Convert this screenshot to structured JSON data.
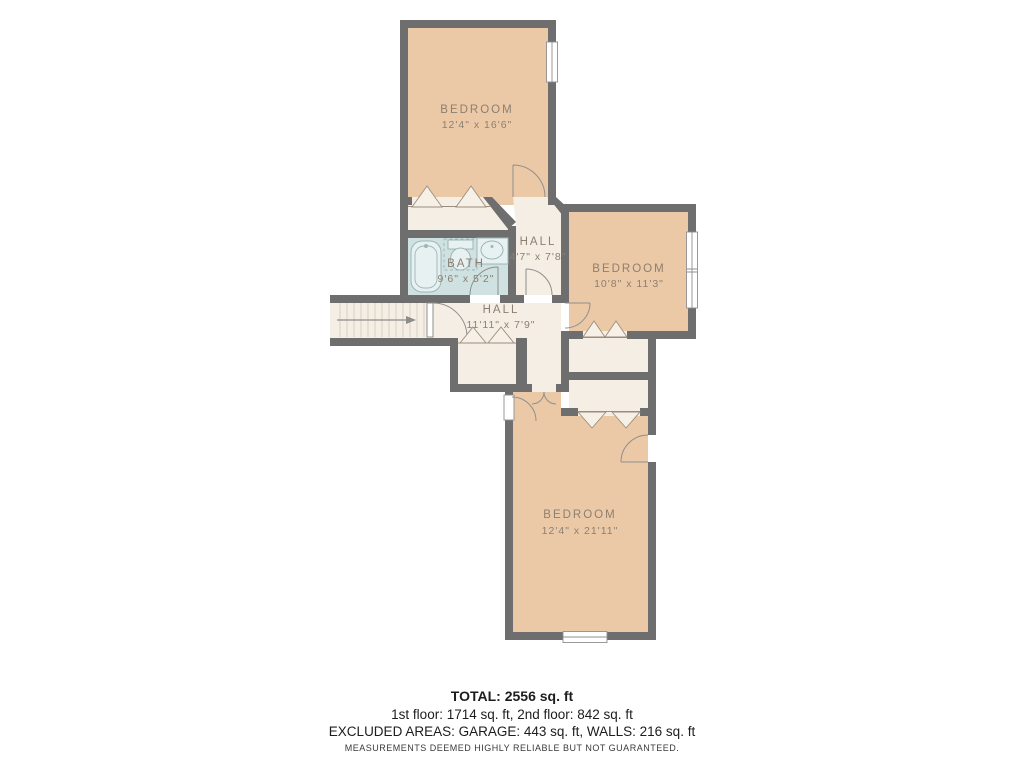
{
  "plan": {
    "rooms": [
      {
        "key": "bedroom-top",
        "label": "BEDROOM",
        "dims": "12'4\" x 16'6\""
      },
      {
        "key": "bath",
        "label": "BATH",
        "dims": "9'6\" x 5'2\""
      },
      {
        "key": "hall-upper",
        "label": "HALL",
        "dims": "4'7\" x 7'8\""
      },
      {
        "key": "bedroom-right",
        "label": "BEDROOM",
        "dims": "10'8\" x 11'3\""
      },
      {
        "key": "hall-main",
        "label": "HALL",
        "dims": "11'11\" x 7'9\""
      },
      {
        "key": "bedroom-bottom",
        "label": "BEDROOM",
        "dims": "12'4\" x 21'11\""
      }
    ],
    "colors": {
      "wall": "#6e6e6e",
      "bedroom_fill": "#ecc9a6",
      "hall_fill": "#f4eee4",
      "bath_fill": "#cfe2e1",
      "fixture_fill": "#e7f1f1",
      "fixture_stroke": "#9db6b6",
      "label_text": "#8c7f71",
      "door_stroke": "#8f8f8f",
      "closet_door_stroke": "#9b8d7d"
    }
  },
  "footer": {
    "total": "TOTAL: 2556 sq. ft",
    "floors": "1st floor: 1714 sq. ft, 2nd floor: 842 sq. ft",
    "excluded": "EXCLUDED AREAS: GARAGE: 443 sq. ft, WALLS: 216 sq. ft",
    "disclaimer": "MEASUREMENTS DEEMED HIGHLY RELIABLE BUT NOT GUARANTEED."
  }
}
